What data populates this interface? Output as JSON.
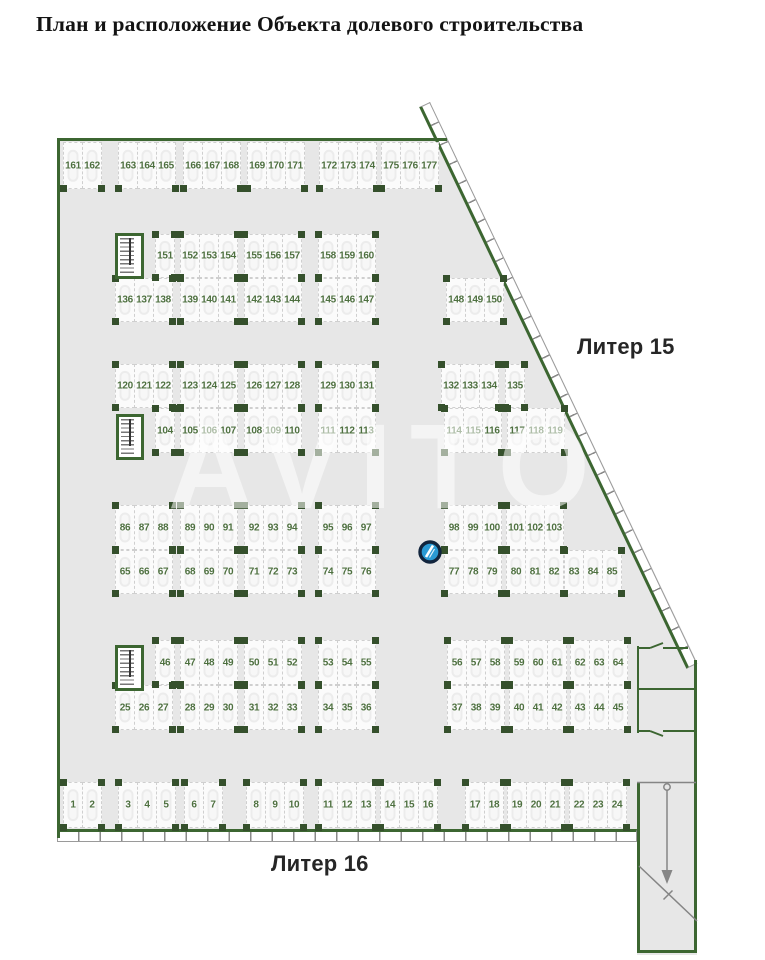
{
  "title": "План и расположение Объекта долевого строительства",
  "labels": {
    "liter15": "Литер 15",
    "liter16": "Литер 16"
  },
  "watermark": "AVITO",
  "colors": {
    "wall": "#3c6631",
    "column": "#35502c",
    "number": "#4e7040",
    "floor": "#e7e7e7",
    "spotBg": "#fbfbfb",
    "spotBorder": "#cfcfcf",
    "markerFill": "#2a9ad4",
    "markerStroke": "#12253d"
  },
  "plan": {
    "rows": [
      {
        "y": 142,
        "h": 47,
        "no_top_columns": true,
        "groups": [
          {
            "x": 63,
            "spots": [
              "161",
              "162"
            ]
          },
          {
            "x": 118,
            "spots": [
              "163",
              "164",
              "165"
            ]
          },
          {
            "x": 183,
            "spots": [
              "166",
              "167",
              "168"
            ]
          },
          {
            "x": 247,
            "spots": [
              "169",
              "170",
              "171"
            ]
          },
          {
            "x": 319,
            "spots": [
              "172",
              "173",
              "174"
            ]
          },
          {
            "x": 381,
            "spots": [
              "175",
              "176",
              "177"
            ]
          }
        ]
      },
      {
        "y": 234,
        "h": 44,
        "groups": [
          {
            "x": 155,
            "spots": [
              "151"
            ]
          },
          {
            "x": 180,
            "spots": [
              "152",
              "153",
              "154"
            ]
          },
          {
            "x": 244,
            "spots": [
              "155",
              "156",
              "157"
            ]
          },
          {
            "x": 318,
            "spots": [
              "158",
              "159",
              "160"
            ]
          }
        ]
      },
      {
        "y": 278,
        "h": 44,
        "groups": [
          {
            "x": 115,
            "spots": [
              "136",
              "137",
              "138"
            ]
          },
          {
            "x": 180,
            "spots": [
              "139",
              "140",
              "141"
            ]
          },
          {
            "x": 244,
            "spots": [
              "142",
              "143",
              "144"
            ]
          },
          {
            "x": 318,
            "spots": [
              "145",
              "146",
              "147"
            ]
          },
          {
            "x": 446,
            "spots": [
              "148",
              "149",
              "150"
            ]
          }
        ]
      },
      {
        "y": 364,
        "h": 44,
        "groups": [
          {
            "x": 115,
            "spots": [
              "120",
              "121",
              "122"
            ]
          },
          {
            "x": 180,
            "spots": [
              "123",
              "124",
              "125"
            ]
          },
          {
            "x": 244,
            "spots": [
              "126",
              "127",
              "128"
            ]
          },
          {
            "x": 318,
            "spots": [
              "129",
              "130",
              "131"
            ]
          },
          {
            "x": 441,
            "spots": [
              "132",
              "133",
              "134"
            ]
          },
          {
            "x": 505,
            "spots": [
              "135"
            ]
          }
        ]
      },
      {
        "y": 408,
        "h": 45,
        "groups": [
          {
            "x": 155,
            "spots": [
              "104"
            ]
          },
          {
            "x": 180,
            "spots": [
              "105",
              "106",
              "107"
            ]
          },
          {
            "x": 244,
            "spots": [
              "108",
              "109",
              "110"
            ]
          },
          {
            "x": 318,
            "spots": [
              "111",
              "112",
              "113"
            ]
          },
          {
            "x": 444,
            "spots": [
              "114",
              "115",
              "116"
            ]
          },
          {
            "x": 507,
            "spots": [
              "117",
              "118",
              "119"
            ]
          }
        ]
      },
      {
        "y": 505,
        "h": 45,
        "groups": [
          {
            "x": 115,
            "spots": [
              "86",
              "87",
              "88"
            ]
          },
          {
            "x": 180,
            "spots": [
              "89",
              "90",
              "91"
            ]
          },
          {
            "x": 244,
            "spots": [
              "92",
              "93",
              "94"
            ]
          },
          {
            "x": 318,
            "spots": [
              "95",
              "96",
              "97"
            ]
          },
          {
            "x": 444,
            "spots": [
              "98",
              "99",
              "100"
            ]
          },
          {
            "x": 506,
            "spots": [
              "101",
              "102",
              "103"
            ]
          }
        ]
      },
      {
        "y": 550,
        "h": 44,
        "groups": [
          {
            "x": 115,
            "spots": [
              "65",
              "66",
              "67"
            ]
          },
          {
            "x": 180,
            "spots": [
              "68",
              "69",
              "70"
            ]
          },
          {
            "x": 244,
            "spots": [
              "71",
              "72",
              "73"
            ]
          },
          {
            "x": 318,
            "spots": [
              "74",
              "75",
              "76"
            ]
          },
          {
            "x": 444,
            "spots": [
              "77",
              "78",
              "79"
            ]
          },
          {
            "x": 506,
            "spots": [
              "80",
              "81",
              "82"
            ]
          },
          {
            "x": 564,
            "spots": [
              "83",
              "84",
              "85"
            ]
          }
        ]
      },
      {
        "y": 640,
        "h": 45,
        "groups": [
          {
            "x": 155,
            "spots": [
              "46"
            ]
          },
          {
            "x": 180,
            "spots": [
              "47",
              "48",
              "49"
            ]
          },
          {
            "x": 244,
            "spots": [
              "50",
              "51",
              "52"
            ]
          },
          {
            "x": 318,
            "spots": [
              "53",
              "54",
              "55"
            ]
          },
          {
            "x": 447,
            "spots": [
              "56",
              "57",
              "58"
            ]
          },
          {
            "x": 509,
            "spots": [
              "59",
              "60",
              "61"
            ]
          },
          {
            "x": 570,
            "spots": [
              "62",
              "63",
              "64"
            ]
          }
        ]
      },
      {
        "y": 685,
        "h": 45,
        "groups": [
          {
            "x": 115,
            "spots": [
              "25",
              "26",
              "27"
            ]
          },
          {
            "x": 180,
            "spots": [
              "28",
              "29",
              "30"
            ]
          },
          {
            "x": 244,
            "spots": [
              "31",
              "32",
              "33"
            ]
          },
          {
            "x": 318,
            "spots": [
              "34",
              "35",
              "36"
            ]
          },
          {
            "x": 447,
            "spots": [
              "37",
              "38",
              "39"
            ]
          },
          {
            "x": 509,
            "spots": [
              "40",
              "41",
              "42"
            ]
          },
          {
            "x": 570,
            "spots": [
              "43",
              "44",
              "45"
            ]
          }
        ]
      },
      {
        "y": 782,
        "h": 46,
        "groups": [
          {
            "x": 63,
            "spots": [
              "1",
              "2"
            ]
          },
          {
            "x": 118,
            "spots": [
              "3",
              "4",
              "5"
            ]
          },
          {
            "x": 184,
            "spots": [
              "6",
              "7"
            ]
          },
          {
            "x": 246,
            "spots": [
              "8",
              "9",
              "10"
            ]
          },
          {
            "x": 318,
            "spots": [
              "11",
              "12",
              "13"
            ]
          },
          {
            "x": 380,
            "spots": [
              "14",
              "15",
              "16"
            ]
          },
          {
            "x": 465,
            "spots": [
              "17",
              "18"
            ]
          },
          {
            "x": 507,
            "spots": [
              "19",
              "20",
              "21"
            ]
          },
          {
            "x": 569,
            "spots": [
              "22",
              "23",
              "24"
            ]
          }
        ]
      }
    ],
    "stairwells": [
      {
        "x": 115,
        "y": 233,
        "w": 29,
        "h": 46
      },
      {
        "x": 116,
        "y": 414,
        "w": 28,
        "h": 46
      },
      {
        "x": 115,
        "y": 645,
        "w": 29,
        "h": 46
      }
    ],
    "marker": {
      "x": 430,
      "y": 552
    }
  }
}
